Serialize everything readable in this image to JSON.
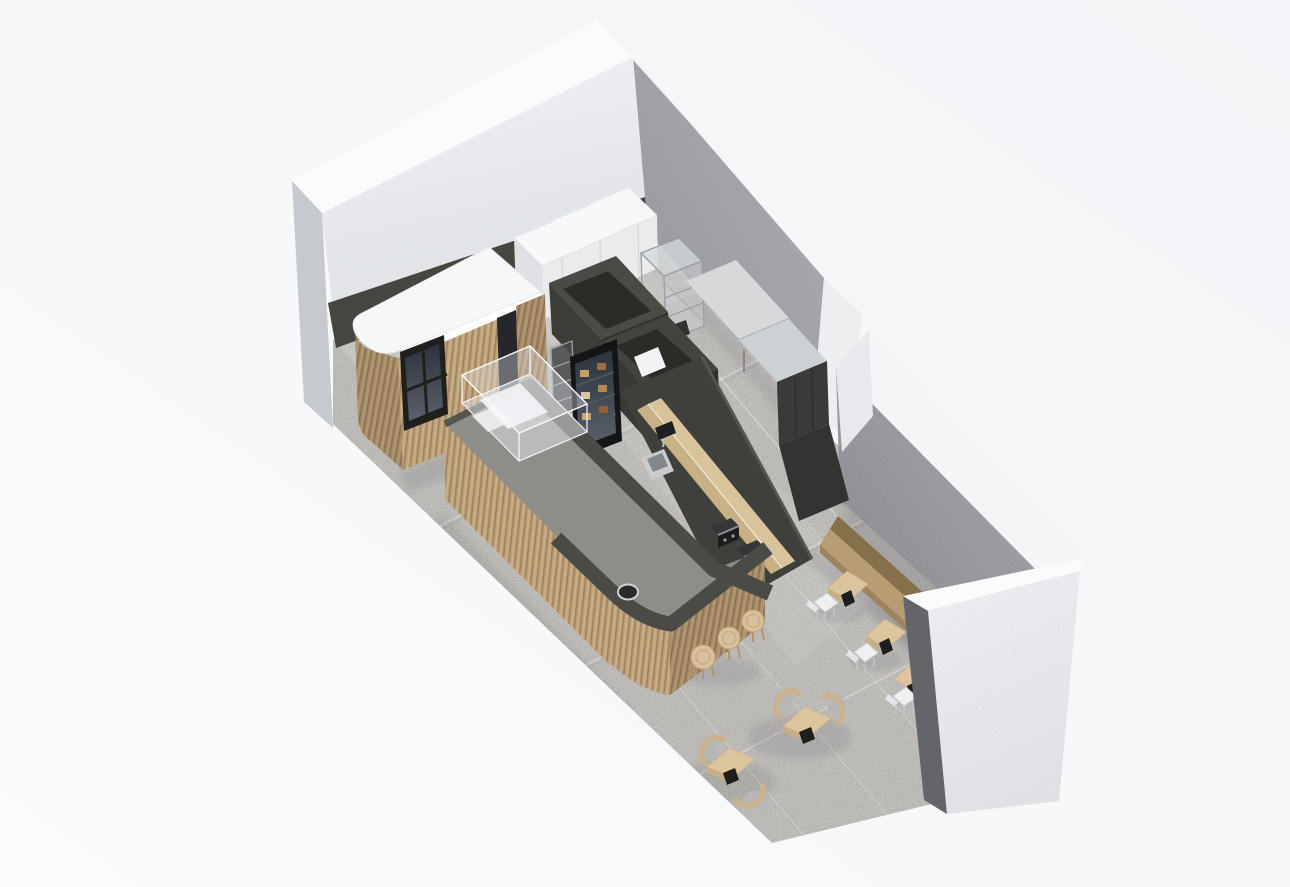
{
  "meta": {
    "type": "3d-isometric-architecture-render",
    "subject": "Cafe / coffee-shop interior - axonometric bird's-eye floor plan render",
    "style": "minimal render: white plaster walls, grey brick walls, charcoal joinery, light oak furniture, grey terrazzo floor",
    "canvas": {
      "width": 1290,
      "height": 887
    }
  },
  "palette": {
    "background": "#f5f6f8",
    "floor_base": "#b7b4b0",
    "wall_top": "#fafbfd",
    "wall_inner_white": "#e8e9ec",
    "wall_end_gray": "#c6c9ce",
    "brick_light": "#a3a5aa",
    "brick_mid": "#97999f",
    "brick_sliver_dark": "#63656b",
    "wall_outer_white": "#eceef1",
    "charcoal": "#3f403c",
    "charcoal_dark": "#2b2c28",
    "counter_band": "#4a4b47",
    "countertop_gray": "#8f8d89",
    "wood_slat": "#bda27a",
    "wood_slat_dark": "#a68c68",
    "kiosk_top_white": "#f6f7f8",
    "shelf_wood": "#d9c39b",
    "table_wood": "#dcc49c",
    "bench_wood": "#b89c74",
    "bench_back": "#857049",
    "stool_wood": "#d9c29b",
    "chair_frame_wood": "#c9b28d",
    "cushion_gray": "#b8b7b5",
    "chair_white": "#eef0f1",
    "steel_light": "#d6d8da",
    "appliance_white": "#eaebed",
    "glass_dark": "#2c333c",
    "espresso_black": "#1c1d1e",
    "window_frame": "#1f201e",
    "shadow": "#3c4046"
  },
  "scene": {
    "walls": [
      {
        "id": "northwest-wall",
        "finish": "white painted plaster",
        "role": "rear wall behind kiosk and refrigerators"
      },
      {
        "id": "northeast-wall-upper",
        "finish": "grey brick",
        "role": "kitchen side wall"
      },
      {
        "id": "northeast-wall-lower",
        "finish": "grey brick",
        "role": "dining side wall with banquette"
      },
      {
        "id": "southeast-wall",
        "finish": "white plaster outer face",
        "role": "corner wall at street side"
      }
    ],
    "opening": {
      "between": "the two northeast wall segments",
      "role": "side entrance doorway"
    },
    "zones": [
      {
        "id": "kitchen",
        "items": [
          "3 white refrigerators",
          "wire racks",
          "2 stainless prep tables",
          "under-counter fridges",
          "2 open-top storage cubicles",
          "task chair"
        ]
      },
      {
        "id": "service-kiosk",
        "items": [
          "timber-slat kiosk",
          "dark pass window",
          "white stone top",
          "side door"
        ]
      },
      {
        "id": "counter",
        "items": [
          "timber-slat J-shaped service counter",
          "glass pastry case",
          "drop-in sink",
          "2 espresso machines",
          "timber back shelf",
          "raised charcoal bar ledge"
        ]
      },
      {
        "id": "dining",
        "items": [
          "wall banquette",
          "3 banquette tables",
          "3 white chairs",
          "2 lounge tables",
          "4 oak armchairs",
          "3 bar stools"
        ]
      }
    ],
    "furniture_counts": {
      "refrigerators_white": 3,
      "wire_racks": 2,
      "stainless_prep_tables": 2,
      "storage_cubicles": 2,
      "display_fridge": 1,
      "glass_pastry_case": 1,
      "espresso_machines": 2,
      "bar_stools": 3,
      "banquette_benches": 1,
      "banquette_tables": 3,
      "white_chairs": 3,
      "lounge_tables": 2,
      "lounge_armchairs": 4
    },
    "floor": {
      "finish": "grey speckled terrazzo tile",
      "tile_joints": "large-format, visible"
    }
  }
}
